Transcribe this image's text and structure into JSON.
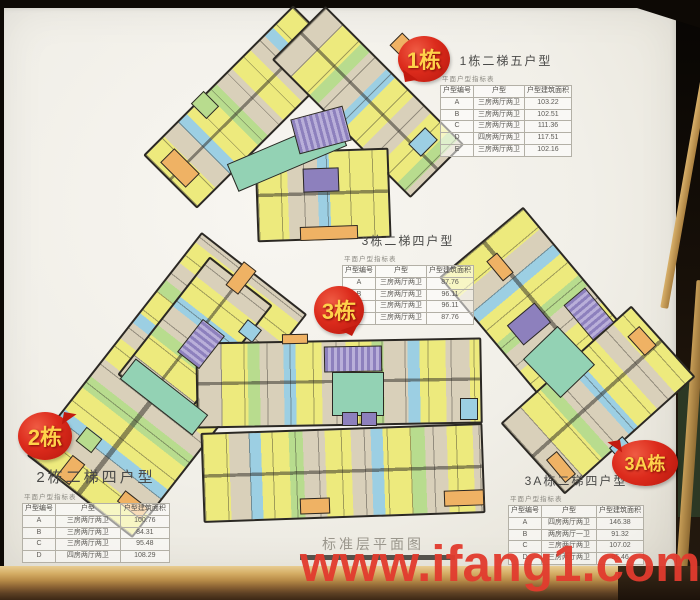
{
  "board": {
    "caption": "标准层平面图",
    "watermark": "www.ifang1.com"
  },
  "badges": {
    "b1": "1栋",
    "b2": "2栋",
    "b3": "3栋",
    "b3a": "3A栋"
  },
  "tables": {
    "b1": {
      "title": "1栋二梯五户型",
      "caption": "平面户型指标表",
      "headers": [
        "户型编号",
        "户型",
        "户型建筑面积"
      ],
      "rows": [
        [
          "A",
          "三房两厅两卫",
          "103.22"
        ],
        [
          "B",
          "三房两厅两卫",
          "102.51"
        ],
        [
          "C",
          "三房两厅两卫",
          "111.36"
        ],
        [
          "D",
          "四房两厅两卫",
          "117.51"
        ],
        [
          "E",
          "三房两厅两卫",
          "102.16"
        ]
      ]
    },
    "b3": {
      "title": "3栋二梯四户型",
      "caption": "平面户型指标表",
      "headers": [
        "户型编号",
        "户型",
        "户型建筑面积"
      ],
      "rows": [
        [
          "A",
          "三房两厅两卫",
          "87.76"
        ],
        [
          "B",
          "三房两厅两卫",
          "96.11"
        ],
        [
          "C",
          "三房两厅两卫",
          "96.11"
        ],
        [
          "D",
          "三房两厅两卫",
          "87.76"
        ]
      ]
    },
    "b2": {
      "title": "2栋二梯四户型",
      "caption": "平面户型指标表",
      "headers": [
        "户型编号",
        "户型",
        "户型建筑面积"
      ],
      "rows": [
        [
          "A",
          "三房两厅两卫",
          "100.76"
        ],
        [
          "B",
          "三房两厅两卫",
          "84.31"
        ],
        [
          "C",
          "三房两厅两卫",
          "95.48"
        ],
        [
          "D",
          "四房两厅两卫",
          "108.29"
        ]
      ]
    },
    "b3a": {
      "title": "3A栋二梯四户型",
      "caption": "平面户型指标表",
      "headers": [
        "户型编号",
        "户型",
        "户型建筑面积"
      ],
      "rows": [
        [
          "A",
          "四房两厅两卫",
          "146.38"
        ],
        [
          "B",
          "两房两厅一卫",
          "91.32"
        ],
        [
          "C",
          "三房两厅两卫",
          "107.02"
        ],
        [
          "D",
          "三房两厅两卫",
          "95.46"
        ]
      ]
    }
  },
  "palette": {
    "badge_red": "#d42318",
    "badge_text_gold": "#ffd24a",
    "unit_yellow": "#edea7d",
    "unit_beige": "#d9d0ba",
    "unit_green": "#b8dc8e",
    "unit_cyan": "#9ccfe3",
    "unit_orange": "#efb264",
    "core_purple": "#8d80bd",
    "corridor_teal": "#93d2b4",
    "watermark_red": "#e23b2e"
  }
}
